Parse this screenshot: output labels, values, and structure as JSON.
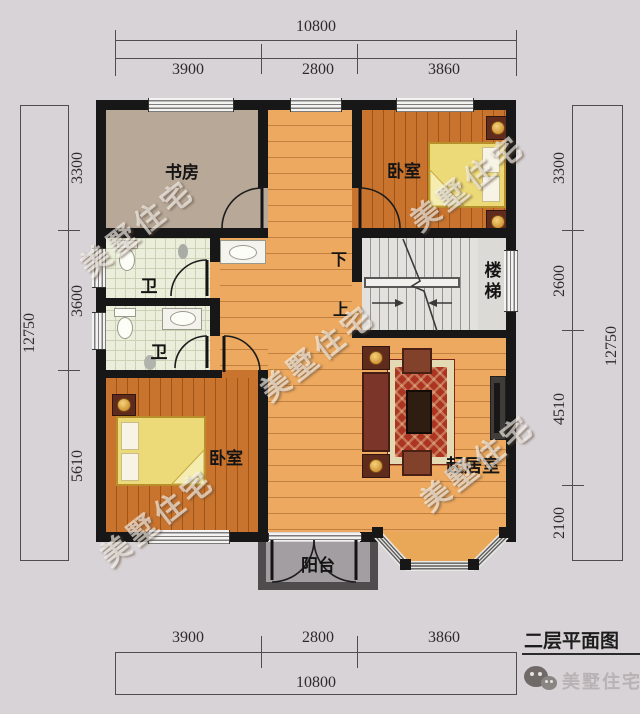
{
  "plan": {
    "title": "二层平面图",
    "brand": "美墅住宅",
    "watermark": "美墅住宅",
    "rooms": {
      "study": "书房",
      "bedroom_top": "卧室",
      "bedroom_bottom": "卧室",
      "bath_upper": "卫",
      "bath_lower": "卫",
      "stairs": "楼梯",
      "living": "起居室",
      "balcony": "阳台"
    },
    "stair_marks": {
      "down": "下",
      "up": "上"
    },
    "dims": {
      "top": {
        "total": "10800",
        "segments": [
          "3900",
          "2800",
          "3860"
        ]
      },
      "bottom": {
        "total": "10800",
        "segments": [
          "3900",
          "2800",
          "3860"
        ]
      },
      "left": {
        "total": "12750",
        "segments": [
          "3300",
          "3600",
          "5610"
        ]
      },
      "right": {
        "total": "12750",
        "segments": [
          "3300",
          "2600",
          "4510",
          "2100"
        ]
      }
    },
    "colors": {
      "wall": "#171717",
      "wood_light": "#eca95f",
      "wood_dark": "#c9742e",
      "study_floor": "#b7a898",
      "bath_tile": "#ebeedb",
      "balcony_floor": "#a29ea1",
      "background": "#d8d3d6"
    }
  }
}
